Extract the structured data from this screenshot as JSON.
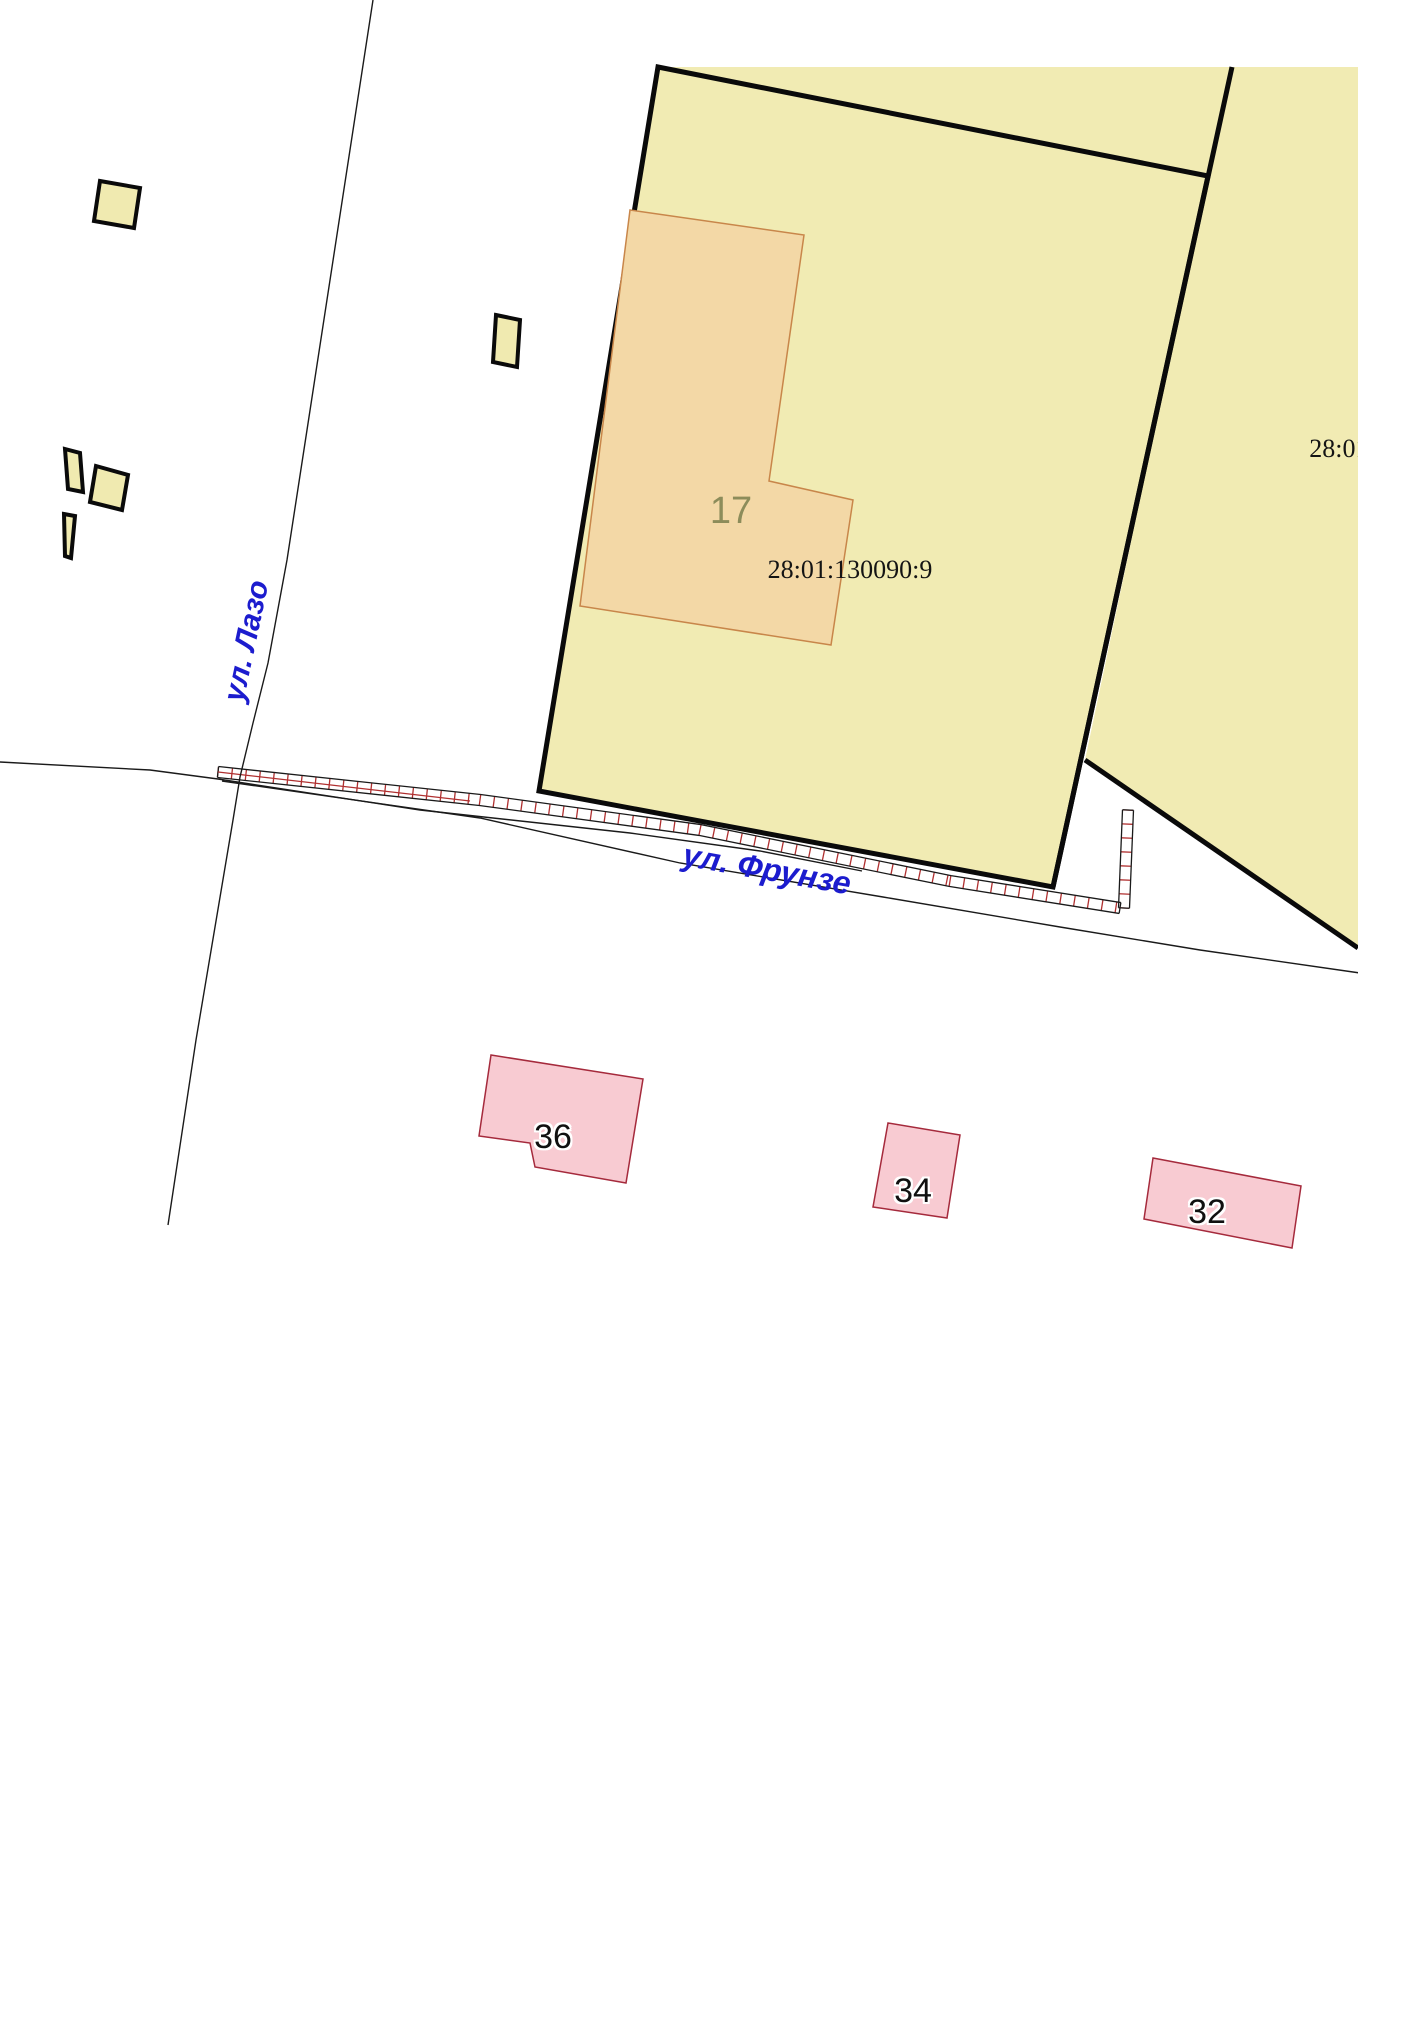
{
  "map": {
    "title": "cadastral-map-fragment",
    "colors": {
      "parcel_fill": "#F1EBB3",
      "parcel_border": "#0a0a0a",
      "building_fill": "#F3D8A6",
      "building_border": "#C8864A",
      "small_building_fill": "#F0EAB0",
      "small_building_border": "#0a0a0a",
      "pink_fill": "#F8CBD2",
      "pink_border": "#A52A3C",
      "fence_red": "#B03030",
      "fence_outline": "#1a1a1a",
      "road_line": "#1a1a1a",
      "label_blue": "#1C1CCE",
      "label_olive": "#8C8C5A",
      "label_black": "#141414"
    },
    "clip_x": 1358,
    "parcels": [
      {
        "name": "parcel-neighbor",
        "cadastral": "28:01",
        "points": "658,67 1358,67 1358,948 1085,760 1208,176",
        "stroked": false
      },
      {
        "name": "parcel-28-01-130090-9",
        "cadastral": "28:01:130090:9",
        "points": "658,67 1208,176 1053,887 539,791",
        "stroked": true
      }
    ],
    "boundary_lines": [
      {
        "name": "parcel-boundary-east",
        "points": "1232,67 1053,887"
      },
      {
        "name": "parcel-boundary-southeast",
        "points": "1085,760 1358,948"
      }
    ],
    "building_17": {
      "name": "building-17",
      "points": "630,210 804,235 769,481 853,500 831,645 580,606"
    },
    "small_buildings": [
      {
        "name": "small-building-1",
        "points": "100,181 140,188 134,228 94,221"
      },
      {
        "name": "small-building-2",
        "points": "496,315 520,320 517,367 493,362"
      },
      {
        "name": "small-building-3",
        "points": "96,466 128,475 122,510 90,502"
      },
      {
        "name": "small-building-4",
        "points": "65,449 80,453 83,492 68,489"
      },
      {
        "name": "small-building-5",
        "points": "64,514 75,516 71,558 65,556"
      }
    ],
    "pink_buildings": [
      {
        "name": "house-36",
        "label": "36",
        "points": "491,1055 643,1079 626,1183 535,1167 530,1143 479,1136"
      },
      {
        "name": "house-34",
        "label": "34",
        "points": "888,1123 960,1135 947,1218 873,1207"
      },
      {
        "name": "house-32",
        "label": "32",
        "points": "1153,1158 1301,1186 1292,1248 1144,1219"
      }
    ],
    "street_lines": [
      {
        "name": "road-line-lazo",
        "points": "373,0 307,430 287,560 268,663 253,723 240,777 233,820 196,1040 168,1225"
      },
      {
        "name": "road-line-frunze-north",
        "points": "0,762 150,770 218,779 420,810 630,833 760,851 862,871"
      },
      {
        "name": "road-line-frunze-south",
        "points": "222,781 480,818 680,863 883,897 1060,927 1200,950 1360,973"
      }
    ],
    "fence": {
      "width": 11,
      "tick_spacing": 14,
      "bands": [
        [
          [
            218,
            772
          ],
          [
            480,
            800
          ],
          [
            700,
            830
          ],
          [
            950,
            881
          ],
          [
            1120,
            908
          ]
        ],
        [
          [
            1124,
            908
          ],
          [
            1128,
            810
          ]
        ]
      ],
      "midline": [
        [
          218,
          772
        ],
        [
          470,
          801
        ]
      ]
    },
    "labels": [
      {
        "text": "17",
        "x": 731,
        "y": 511,
        "size": 38,
        "color": "#8C8C5A",
        "rot": 0,
        "font": "sans",
        "bold": false,
        "italic": false,
        "halo": false
      },
      {
        "text": "28:01:130090:9",
        "x": 850,
        "y": 570,
        "size": 26,
        "color": "#141414",
        "rot": 0,
        "font": "serif",
        "bold": false,
        "italic": false,
        "halo": false
      },
      {
        "text": "28:01:1",
        "x": 1349,
        "y": 449,
        "size": 26,
        "color": "#141414",
        "rot": 0,
        "font": "serif",
        "bold": false,
        "italic": false,
        "halo": false
      },
      {
        "text": "ул. Лазо",
        "x": 247,
        "y": 641,
        "size": 30,
        "color": "#1C1CCE",
        "rot": -78,
        "font": "sans",
        "bold": true,
        "italic": true,
        "halo": false
      },
      {
        "text": "ул. Фрунзе",
        "x": 767,
        "y": 869,
        "size": 32,
        "color": "#1C1CCE",
        "rot": 10,
        "font": "sans",
        "bold": true,
        "italic": true,
        "halo": false
      },
      {
        "text": "36",
        "x": 553,
        "y": 1137,
        "size": 34,
        "color": "#101010",
        "rot": 0,
        "font": "sans",
        "bold": false,
        "italic": false,
        "halo": true
      },
      {
        "text": "34",
        "x": 913,
        "y": 1191,
        "size": 34,
        "color": "#101010",
        "rot": 0,
        "font": "sans",
        "bold": false,
        "italic": false,
        "halo": true
      },
      {
        "text": "32",
        "x": 1207,
        "y": 1212,
        "size": 34,
        "color": "#101010",
        "rot": 0,
        "font": "sans",
        "bold": false,
        "italic": false,
        "halo": true
      }
    ]
  }
}
